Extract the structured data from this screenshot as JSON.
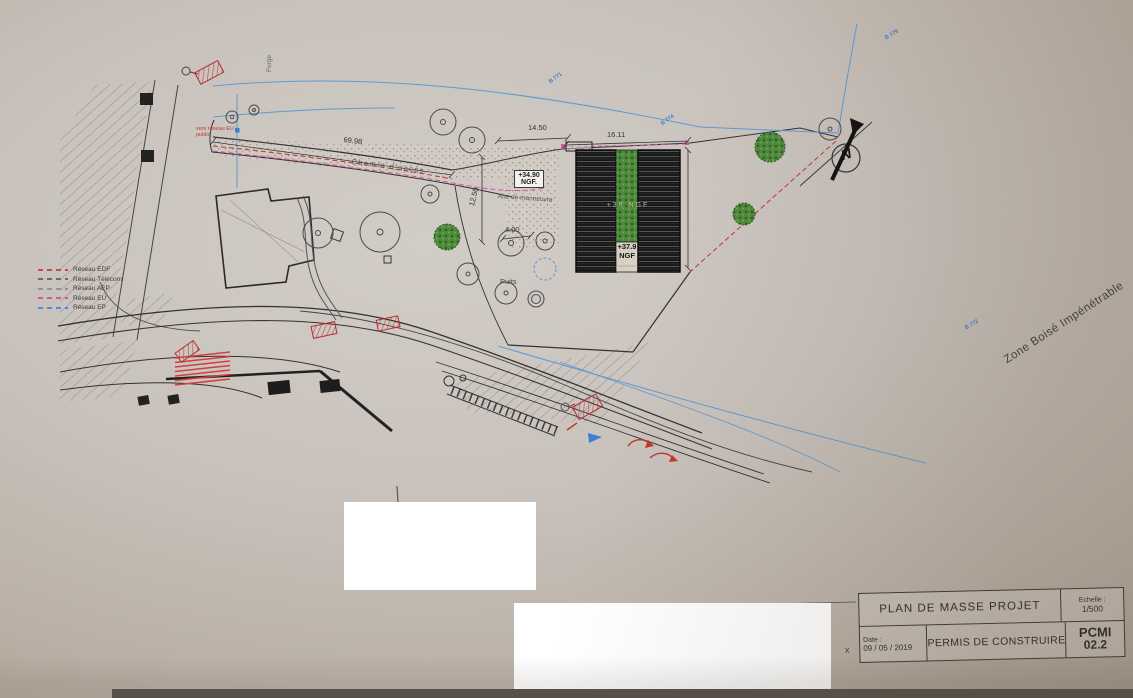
{
  "plan": {
    "legend": {
      "items": [
        {
          "label": "Réseau EDF",
          "color": "#c84b4b"
        },
        {
          "label": "Réseau Télécom",
          "color": "#6b6b6b"
        },
        {
          "label": "Réseau AEP",
          "color": "#8b94a0"
        },
        {
          "label": "Réseau EU",
          "color": "#d557a0"
        },
        {
          "label": "Réseau EP",
          "color": "#4a90d9"
        }
      ]
    },
    "labels": {
      "chemin_dacces": "Chemin d'accès",
      "aire_de_manoeuvre": "Aire de manoeuvre",
      "puits": "Puits",
      "forge": "Forge",
      "vers_reseau_eu": "vers réseau EU public",
      "zone_boisee": "Zone Boisé Impénétrable",
      "niveau_haut_line1": "+34.90",
      "niveau_haut_line2": "NGF.",
      "faitage": "+38 NGF",
      "niveau_faitage_line1": "+37.9",
      "niveau_faitage_line2": "NGF"
    },
    "dimensions": {
      "top_left": "14.50",
      "top_right": "16.11",
      "left_vertical": "12.50",
      "small": "4.00",
      "road_length": "69.98"
    },
    "survey_points": [
      {
        "label": "B 771"
      },
      {
        "label": "B 774"
      },
      {
        "label": "B 779"
      },
      {
        "label": "B 772"
      }
    ],
    "north_letter": "N",
    "stray_char": "x"
  },
  "title_block": {
    "title": "PLAN DE MASSE PROJET",
    "scale_label": "Echelle :",
    "scale_value": "1/500",
    "date_label": "Date :",
    "date_value": "09 / 05 / 2019",
    "document_type": "PERMIS DE CONSTRUIRE",
    "code": "PCMI",
    "code_index": "02.2"
  }
}
